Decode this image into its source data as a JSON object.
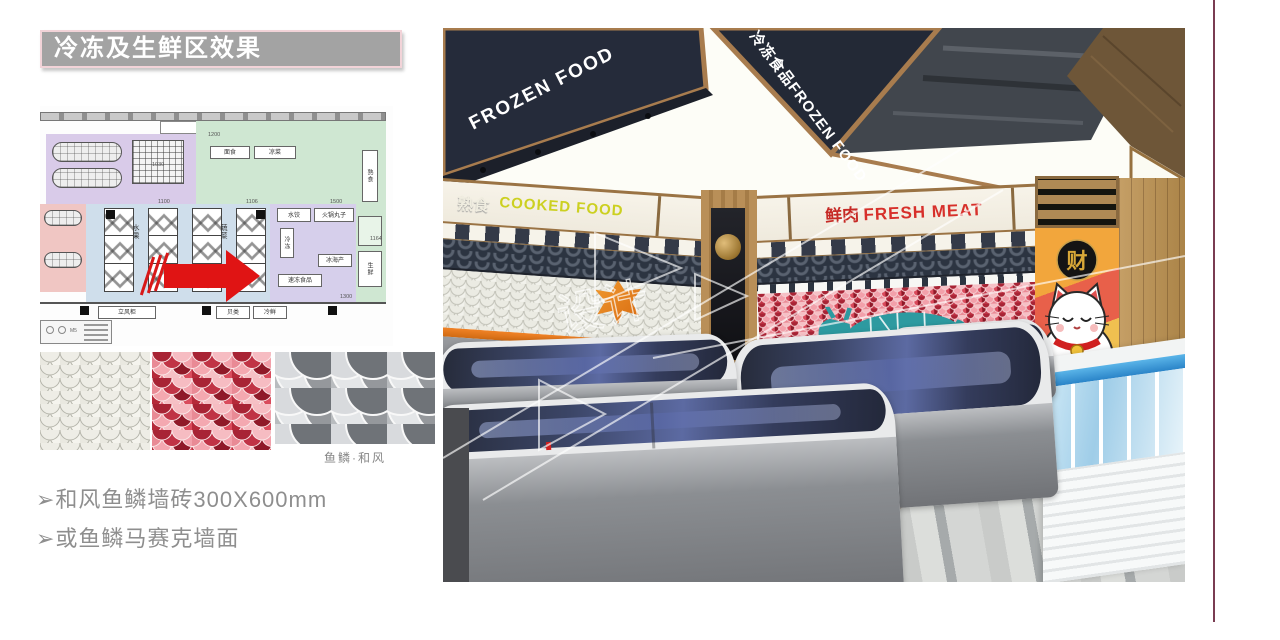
{
  "slide": {
    "title": "冷冻及生鲜区效果",
    "bullets": [
      "➢和风鱼鳞墙砖300X600mm",
      "➢或鱼鳞马赛克墙面"
    ],
    "swatch_caption": "鱼鳞·和风",
    "colors": {
      "title_bg": "#a3a3a3",
      "title_border": "#f2d3d8",
      "accent_line": "#7a3c52",
      "arrow_red": "#e01414",
      "orange_trim": "#e87a1e"
    }
  },
  "floorplan": {
    "labels": [
      "面包架",
      "面包架",
      "面食",
      "凉菜",
      "熟食",
      "水果",
      "蔬菜",
      "水饺",
      "火锅丸子",
      "冷冻",
      "冰海产",
      "速冻食品",
      "立风柜",
      "贝类",
      "冷鲜",
      "生鲜",
      "M5"
    ],
    "dims": [
      "1030",
      "1200",
      "1100",
      "1106",
      "1500",
      "1164",
      "1300"
    ]
  },
  "render": {
    "ceiling_sign_left": "FROZEN FOOD",
    "ceiling_sign_right": "冷冻食品FROZEN FOOD",
    "cooked_zh": "熟食",
    "cooked_en": "COOKED FOOD",
    "meat_zh": "鲜肉",
    "meat_en": "FRESH MEAT",
    "cat_char": "财",
    "watermark": "设计"
  }
}
